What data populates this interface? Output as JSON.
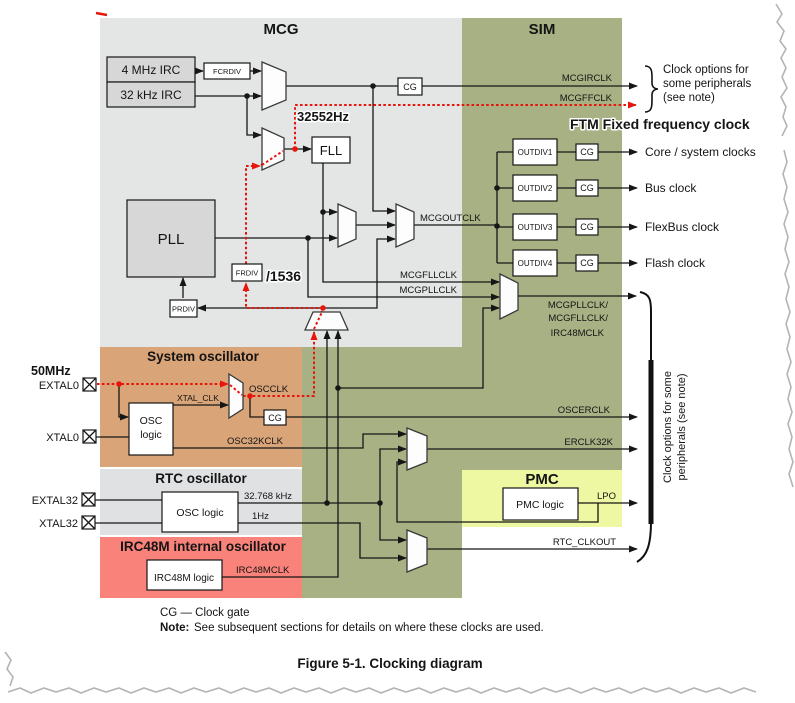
{
  "colors": {
    "mcg_bg": "#e4e6e6",
    "sim_green": "#a7b183",
    "osc_tan": "#d9a478",
    "rtc_gray": "#dfe1e2",
    "irc48_pink": "#f9827a",
    "pmc_yellow": "#eef7a2",
    "box_gray": "#d7d7d7",
    "accent_red": "#e8150d",
    "accent_blue": "#3a75c8",
    "accent_magenta": "#ee16ee"
  },
  "titles": {
    "mcg": "MCG",
    "sim": "SIM",
    "sys_osc": "System oscillator",
    "rtc_osc": "RTC oscillator",
    "irc48_osc": "IRC48M internal oscillator",
    "pmc": "PMC"
  },
  "blocks": {
    "irc_4mhz": "4 MHz IRC",
    "irc_32khz": "32 kHz IRC",
    "fcrdiv": "FCRDIV",
    "fll": "FLL",
    "pll": "PLL",
    "frdiv": "FRDIV",
    "prdiv": "PRDIV",
    "outdiv1": "OUTDIV1",
    "outdiv2": "OUTDIV2",
    "outdiv3": "OUTDIV3",
    "outdiv4": "OUTDIV4",
    "cg": "CG",
    "osc_logic_line1": "OSC",
    "osc_logic_line2": "logic",
    "rtc_osc_logic": "OSC logic",
    "pmc_logic": "PMC logic",
    "irc48m_logic": "IRC48M logic"
  },
  "signals": {
    "mcgirclk": "MCGIRCLK",
    "mcgffclk": "MCGFFCLK",
    "mcgoutclk": "MCGOUTCLK",
    "mcgfllclk": "MCGFLLCLK",
    "mcgpllclk": "MCGPLLCLK",
    "pllfll_out1": "MCGPLLCLK/",
    "pllfll_out2": "MCGFLLCLK/",
    "pllfll_out3": "IRC48MCLK",
    "oscclk": "OSCCLK",
    "xtal_clk": "XTAL_CLK",
    "osc32kclk": "OSC32KCLK",
    "oscerclk": "OSCERCLK",
    "erclk32k": "ERCLK32K",
    "lpo": "LPO",
    "rtc_clkout": "RTC_CLKOUT",
    "rtc_32k": "32.768 kHz",
    "rtc_1hz": "1Hz",
    "irc48mclk": "IRC48MCLK"
  },
  "pads": {
    "extal0": "EXTAL0",
    "xtal0": "XTAL0",
    "extal32": "EXTAL32",
    "xtal32": "XTAL32"
  },
  "outputs": {
    "core": "Core / system clocks",
    "bus": "Bus clock",
    "flexbus": "FlexBus clock",
    "flash": "Flash clock"
  },
  "annotations": {
    "fll_freq": "32552Hz",
    "fll_div": "/1536",
    "ext_freq": "50MHz",
    "ftm_note": "FTM Fixed frequency clock",
    "clkopt_line1": "Clock options for",
    "clkopt_line2": "some peripherals",
    "clkopt_line3": "(see note)",
    "side_line1": "Clock options for some",
    "side_line2": "peripherals (see note)"
  },
  "footer": {
    "cg_legend": "CG — Clock gate",
    "note_label": "Note:",
    "note_text": "See subsequent sections for details on where these clocks are used.",
    "caption": "Figure 5-1. Clocking diagram"
  }
}
